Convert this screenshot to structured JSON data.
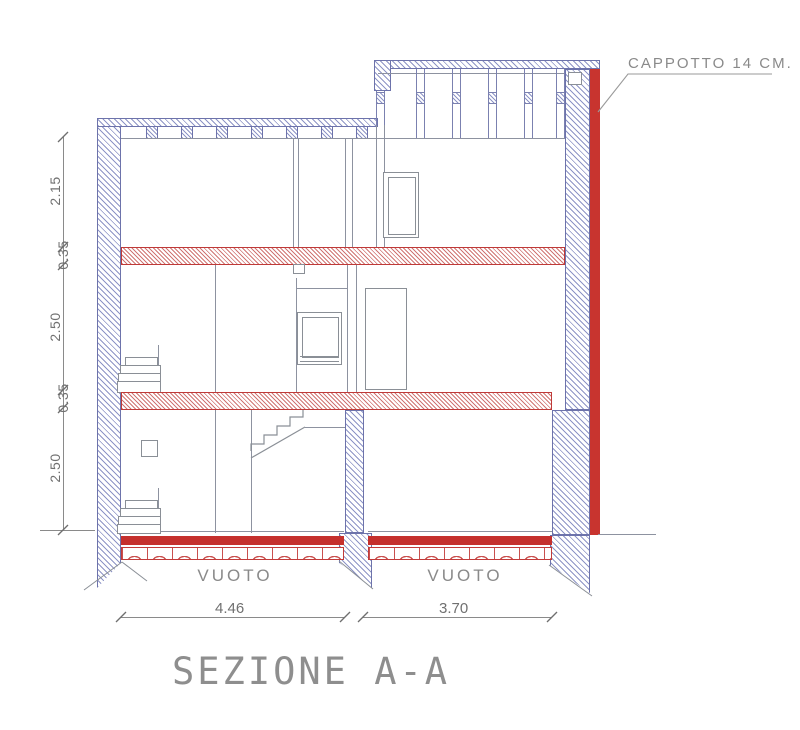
{
  "drawing_title": "SEZIONE A-A",
  "annotations": {
    "insulation": "CAPPOTTO 14 CM."
  },
  "void_labels": [
    "VUOTO",
    "VUOTO"
  ],
  "dimensions": {
    "left": [
      "2.15",
      "0.35",
      "2.50",
      "0.35",
      "2.50"
    ],
    "bottom": [
      "4.46",
      "3.70"
    ]
  },
  "colors": {
    "wall_hatch": "#8d94c6",
    "wall_outline": "#6d73ab",
    "slab_hatch": "#d07573",
    "slab_outline": "#bf3a38",
    "insulation_red": "#c8342f",
    "floor_red": "#c5302d",
    "line_gray": "#8d92a0",
    "dim_text": "#707070"
  }
}
